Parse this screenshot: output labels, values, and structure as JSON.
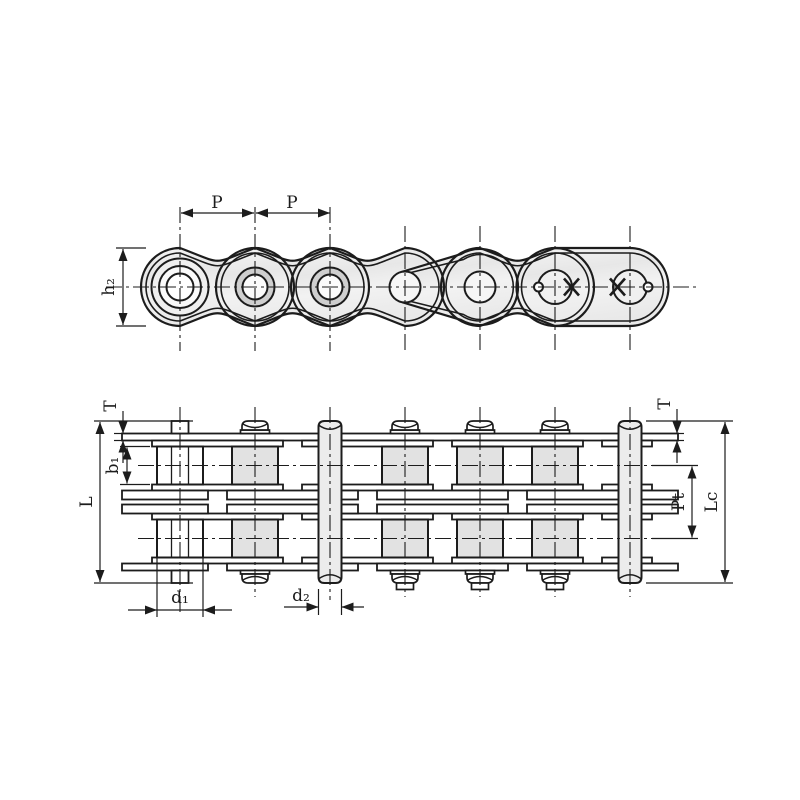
{
  "drawing": {
    "title": "Duplex roller chain engineering drawing",
    "colors": {
      "line": "#1c1c1c",
      "metal_light": "#f3f3f3",
      "metal_mid": "#e4e4e4",
      "roller_shade": "#e2e2e2",
      "roller_annulus": "#cfcfcf",
      "pin_fill": "#ececec",
      "background": "#ffffff"
    },
    "top_view": {
      "name": "side-elevation",
      "labels": {
        "pitch_1": "P",
        "pitch_2": "P",
        "plate_height": "h₂"
      }
    },
    "bottom_view": {
      "name": "plan-view-duplex",
      "labels": {
        "plate_thickness_left": "T",
        "plate_thickness_right": "T",
        "inner_width": "b₁",
        "pin_length": "L",
        "transverse_pitch": "Pt",
        "connecting_link_length": "Lc",
        "roller_diameter": "d₁",
        "pin_diameter": "d₂"
      }
    }
  }
}
